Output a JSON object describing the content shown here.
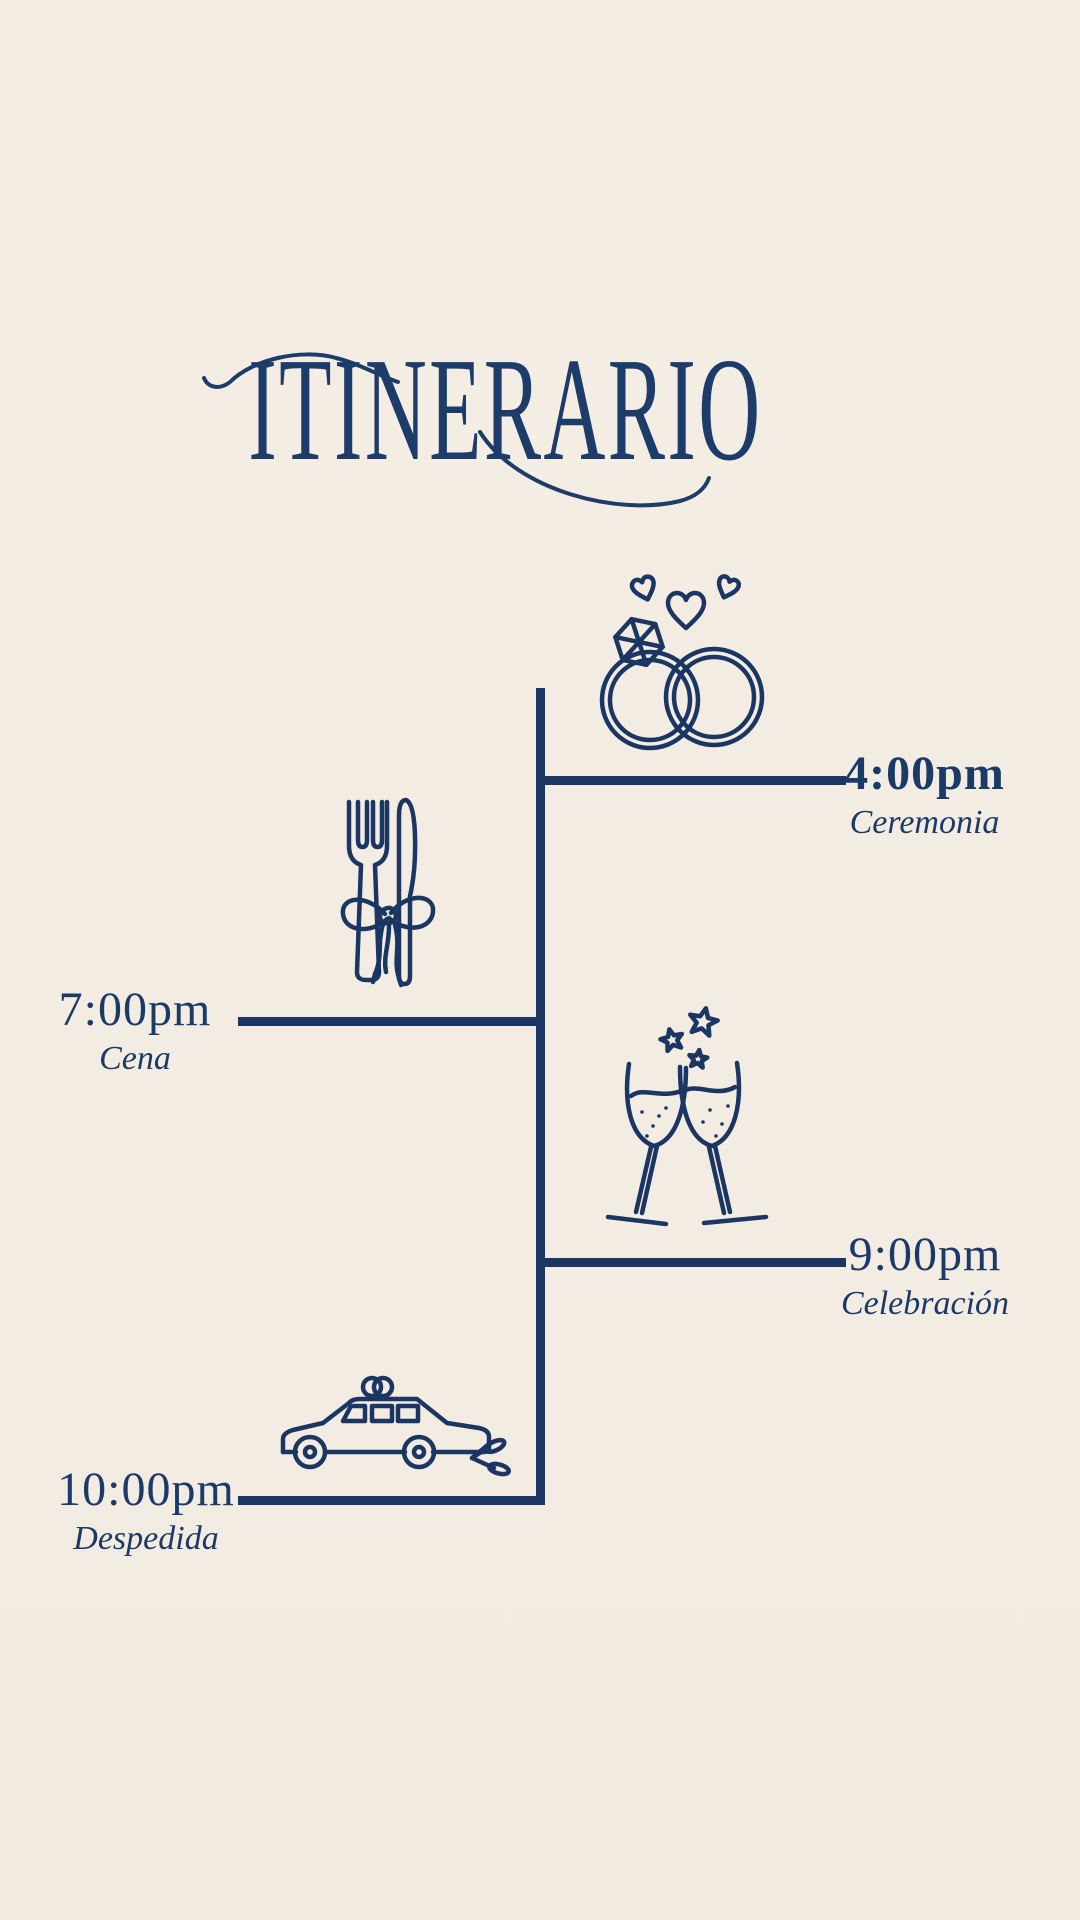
{
  "title": "ITINERARIO",
  "colors": {
    "background": "#f3ece2",
    "ink": "#1c3a67",
    "line": "#1b3662"
  },
  "timeline": {
    "events": [
      {
        "time": "4:00pm",
        "label": "Ceremonia",
        "icon": "wedding-rings-icon",
        "side": "right",
        "time_bold": true
      },
      {
        "time": "7:00pm",
        "label": "Cena",
        "icon": "cutlery-bow-icon",
        "side": "left",
        "time_bold": false
      },
      {
        "time": "9:00pm",
        "label": "Celebración",
        "icon": "champagne-toast-icon",
        "side": "right",
        "time_bold": false
      },
      {
        "time": "10:00pm",
        "label": "Despedida",
        "icon": "wedding-car-icon",
        "side": "left",
        "time_bold": false
      }
    ]
  }
}
